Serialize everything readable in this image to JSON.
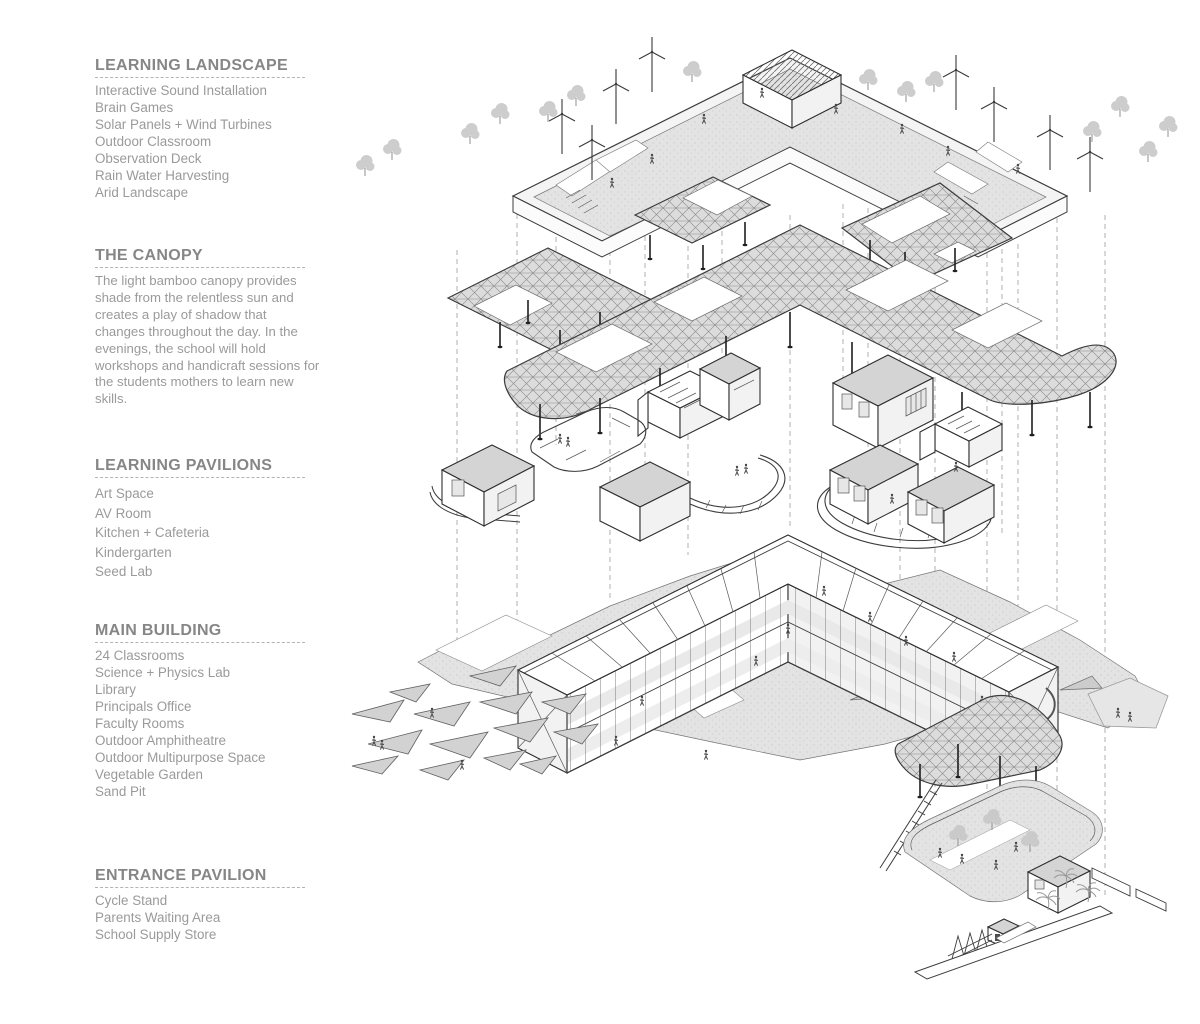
{
  "sections": [
    {
      "title": "LEARNING LANDSCAPE",
      "items": [
        "Interactive Sound Installation",
        "Brain Games",
        "Solar Panels + Wind Turbines",
        "Outdoor Classroom",
        "Observation Deck",
        "Rain Water Harvesting",
        "Arid Landscape"
      ]
    },
    {
      "title": "THE CANOPY",
      "paragraph": "The light bamboo canopy provides shade from the relentless sun and creates a play of shadow that changes throughout the day. In the evenings, the school will hold workshops and handicraft sessions for the students mothers to learn new skills."
    },
    {
      "title": "LEARNING PAVILIONS",
      "items": [
        "Art Space",
        "AV Room",
        "Kitchen + Cafeteria",
        "Kindergarten",
        "Seed Lab"
      ]
    },
    {
      "title": "MAIN BUILDING",
      "items": [
        "24 Classrooms",
        "Science + Physics Lab",
        "Library",
        "Principals Office",
        "Faculty Rooms",
        "Outdoor Amphitheatre",
        "Outdoor Multipurpose Space",
        "Vegetable Garden",
        "Sand Pit"
      ]
    },
    {
      "title": "ENTRANCE PAVILION",
      "items": [
        "Cycle Stand",
        "Parents Waiting Area",
        "School Supply Store"
      ]
    }
  ],
  "colors": {
    "background": "#ffffff",
    "heading_text": "#868686",
    "body_text": "#9a9a9a",
    "drawing_line": "#3c3c3c",
    "ground_fill": "#e3e3e3",
    "roof_fill": "#d4d4d4"
  }
}
